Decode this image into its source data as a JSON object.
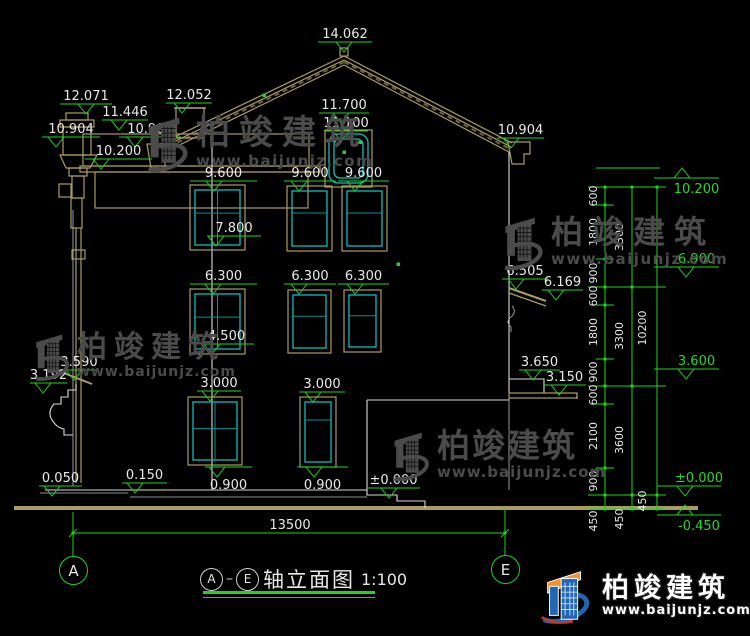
{
  "drawing": {
    "title_bar": {
      "axis_a": "A",
      "axis_e": "E",
      "name": "轴立面图",
      "scale": "1:100"
    },
    "overall_dim": {
      "label": "13500"
    },
    "axis_bubbles": [
      {
        "label": "A",
        "cx": 73,
        "cy": 570
      },
      {
        "label": "E",
        "cx": 505,
        "cy": 569
      }
    ],
    "markers": [
      {
        "l": "14.062",
        "x1": 318,
        "x2": 372,
        "ax": 344,
        "y": 42
      },
      {
        "l": "12.071",
        "x1": 60,
        "x2": 112,
        "ax": 86,
        "y": 104
      },
      {
        "l": "11.446",
        "x1": 102,
        "x2": 148,
        "ax": 119,
        "y": 120
      },
      {
        "l": "12.052",
        "x1": 166,
        "x2": 212,
        "ax": 182,
        "y": 103
      },
      {
        "l": "10.904",
        "x1": 42,
        "x2": 100,
        "ax": 56,
        "y": 137
      },
      {
        "l": "10.904",
        "x1": 119,
        "x2": 181,
        "ax": 135,
        "y": 137
      },
      {
        "l": "10.200",
        "x1": 85,
        "x2": 152,
        "ax": 101,
        "y": 159
      },
      {
        "l": "11.700",
        "x1": 319,
        "x2": 369,
        "ax": 341,
        "y": 113
      },
      {
        "l": "11.100",
        "x1": 324,
        "x2": 368,
        "ax": 341,
        "y": 131
      },
      {
        "l": "10.904",
        "x1": 497,
        "x2": 544,
        "ax": 511,
        "y": 138
      },
      {
        "l": "9.600",
        "x1": 190,
        "x2": 257,
        "ax": 214,
        "y": 181
      },
      {
        "l": "9.600",
        "x1": 284,
        "x2": 336,
        "ax": 299,
        "y": 181
      },
      {
        "l": "9.600",
        "x1": 338,
        "x2": 389,
        "ax": 355,
        "y": 181
      },
      {
        "l": "7.800",
        "x1": 207,
        "x2": 261,
        "ax": 216,
        "y": 236
      },
      {
        "l": "6.300",
        "x1": 190,
        "x2": 257,
        "ax": 213,
        "y": 284
      },
      {
        "l": "6.300",
        "x1": 284,
        "x2": 336,
        "ax": 299,
        "y": 284
      },
      {
        "l": "6.300",
        "x1": 338,
        "x2": 389,
        "ax": 355,
        "y": 284
      },
      {
        "l": "4.500",
        "x1": 199,
        "x2": 254,
        "ax": 212,
        "y": 344
      },
      {
        "l": "3.590",
        "x1": 59,
        "x2": 99,
        "ax": 74,
        "y": 370
      },
      {
        "l": "3.192",
        "x1": 30,
        "x2": 67,
        "ax": 43,
        "y": 383
      },
      {
        "l": "6.505",
        "x1": 502,
        "x2": 548,
        "ax": 516,
        "y": 279
      },
      {
        "l": "6.169",
        "x1": 542,
        "x2": 583,
        "ax": 556,
        "y": 290
      },
      {
        "l": "3.650",
        "x1": 519,
        "x2": 560,
        "ax": 533,
        "y": 370
      },
      {
        "l": "3.150",
        "x1": 543,
        "x2": 586,
        "ax": 559,
        "y": 385
      },
      {
        "l": "3.000",
        "x1": 197,
        "x2": 241,
        "ax": 210,
        "y": 391
      },
      {
        "l": "3.000",
        "x1": 299,
        "x2": 345,
        "ax": 313,
        "y": 392
      },
      {
        "l": "0.050",
        "x1": 39,
        "x2": 82,
        "ax": 52,
        "y": 486
      },
      {
        "l": "0.150",
        "x1": 122,
        "x2": 167,
        "ax": 135,
        "y": 483
      },
      {
        "l": "0.900",
        "x1": 205,
        "x2": 252,
        "ax": 217,
        "y": 467,
        "t": "b"
      },
      {
        "l": "0.900",
        "x1": 297,
        "x2": 348,
        "ax": 314,
        "y": 467,
        "t": "b"
      },
      {
        "l": "±0.000",
        "x1": 367,
        "x2": 420,
        "ax": 389,
        "y": 488
      },
      {
        "l": "10.200",
        "x1": 654,
        "x2": 719,
        "ax": 682,
        "y": 178,
        "t": "gu"
      },
      {
        "l": "6.900",
        "x1": 654,
        "x2": 719,
        "ax": 686,
        "y": 267,
        "t": "gd"
      },
      {
        "l": "3.600",
        "x1": 654,
        "x2": 719,
        "ax": 686,
        "y": 369,
        "t": "gd"
      },
      {
        "l": "±0.000",
        "x1": 657,
        "x2": 721,
        "ax": 685,
        "y": 486,
        "t": "gd"
      },
      {
        "l": "-0.450",
        "x1": 657,
        "x2": 721,
        "ax": 685,
        "y": 515,
        "t": "gu"
      }
    ],
    "chains": [
      {
        "x": 605,
        "lx": 597,
        "ticks": [
          187,
          205,
          259,
          287,
          305,
          359,
          386,
          404,
          468,
          495,
          509
        ],
        "segs": [
          [
            "600",
            196
          ],
          [
            "1800",
            232
          ],
          [
            "900",
            273
          ],
          [
            "600",
            296
          ],
          [
            "1800",
            332
          ],
          [
            "900",
            372
          ],
          [
            "600",
            395
          ],
          [
            "2100",
            436
          ],
          [
            "900",
            481
          ],
          [
            "450",
            521
          ]
        ]
      },
      {
        "x": 632,
        "lx": 623,
        "ticks": [
          187,
          287,
          386,
          495,
          509
        ],
        "segs": [
          [
            "3300",
            237
          ],
          [
            "3300",
            336
          ],
          [
            "3600",
            440
          ],
          [
            "450",
            519
          ]
        ]
      },
      {
        "x": 657,
        "lx": 646,
        "ticks": [
          187,
          495,
          509
        ],
        "segs": [
          [
            "10200",
            328
          ],
          [
            "450",
            501
          ]
        ]
      }
    ],
    "windows": [
      {
        "x": 190,
        "y": 185,
        "w": 55,
        "h": 65,
        "m": "g",
        "dy": 0.42
      },
      {
        "x": 287,
        "y": 186,
        "w": 45,
        "h": 65,
        "m": "h",
        "dy": 0.4
      },
      {
        "x": 342,
        "y": 186,
        "w": 45,
        "h": 65,
        "m": "h",
        "dy": 0.4
      },
      {
        "x": 190,
        "y": 289,
        "w": 55,
        "h": 65,
        "m": "g",
        "dy": 0.42
      },
      {
        "x": 288,
        "y": 290,
        "w": 43,
        "h": 63,
        "m": "h",
        "dy": 0.4
      },
      {
        "x": 344,
        "y": 290,
        "w": 37,
        "h": 62,
        "m": "h",
        "dy": 0.4
      },
      {
        "x": 188,
        "y": 397,
        "w": 54,
        "h": 68,
        "m": "g",
        "dy": 0.46
      },
      {
        "x": 300,
        "y": 397,
        "w": 36,
        "h": 70,
        "m": "h",
        "dy": 0.3
      },
      {
        "x": 329,
        "y": 134,
        "w": 39,
        "h": 49,
        "m": "attic"
      }
    ],
    "grips": [
      [
        264,
        95
      ],
      [
        398,
        264
      ],
      [
        334,
        140
      ],
      [
        360,
        142
      ],
      [
        344,
        152
      ]
    ],
    "watermark": {
      "brand": "柏竣建筑",
      "url": "www.baijunjz.com"
    },
    "logo": {
      "brand": "柏竣建筑",
      "url": "www.baijunjz.com"
    },
    "colors": {
      "dim_green": "#1fd31f",
      "line_white": "#d9d9d9",
      "roof_tan": "#ab9c60",
      "window_cyan": "#12bdbd",
      "watermark_gray": "#4b4b4b",
      "logo_blue": "#1f66b5",
      "logo_orange": "#f0922d"
    }
  }
}
